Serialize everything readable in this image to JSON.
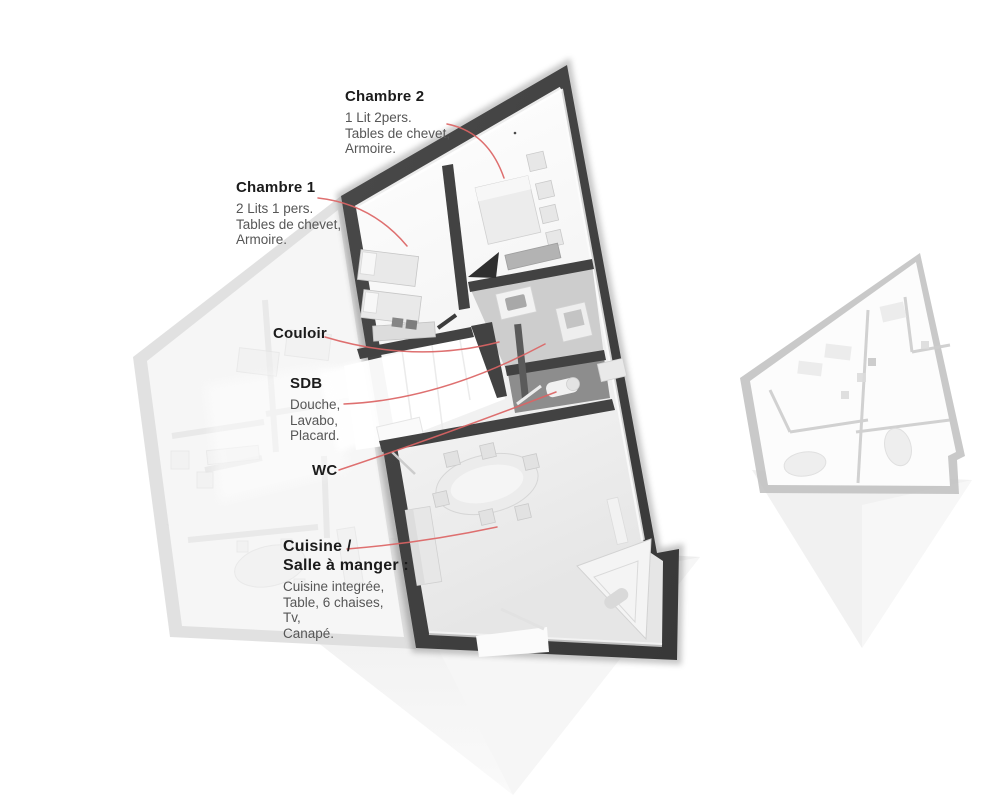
{
  "figure": {
    "kind": "apartment floor plan with callouts",
    "background": "#ffffff"
  },
  "colors": {
    "wall_dark": "#3f3f3f",
    "ghost_wall": "#d9d9d9",
    "thumbnail_wall": "#bfbfbf",
    "leader_line": "#dc6464",
    "title_text": "#1b1b1b",
    "body_text": "#565656"
  },
  "labels": {
    "chambre2": {
      "title": "Chambre 2",
      "details": [
        "1 Lit 2pers.",
        "Tables de chevet,",
        "Armoire."
      ]
    },
    "chambre1": {
      "title": "Chambre 1",
      "details": [
        "2 Lits 1 pers.",
        "Tables de chevet,",
        "Armoire."
      ]
    },
    "couloir": {
      "title": "Couloir",
      "details": []
    },
    "sdb": {
      "title": "SDB",
      "details": [
        "Douche,",
        "Lavabo,",
        "Placard."
      ]
    },
    "wc": {
      "title": "WC",
      "details": []
    },
    "cuisine": {
      "title_line1": "Cuisine /",
      "title_line2": "Salle à manger :",
      "details": [
        "Cuisine integrée,",
        "Table, 6 chaises,",
        "Tv,",
        "Canapé."
      ]
    }
  }
}
